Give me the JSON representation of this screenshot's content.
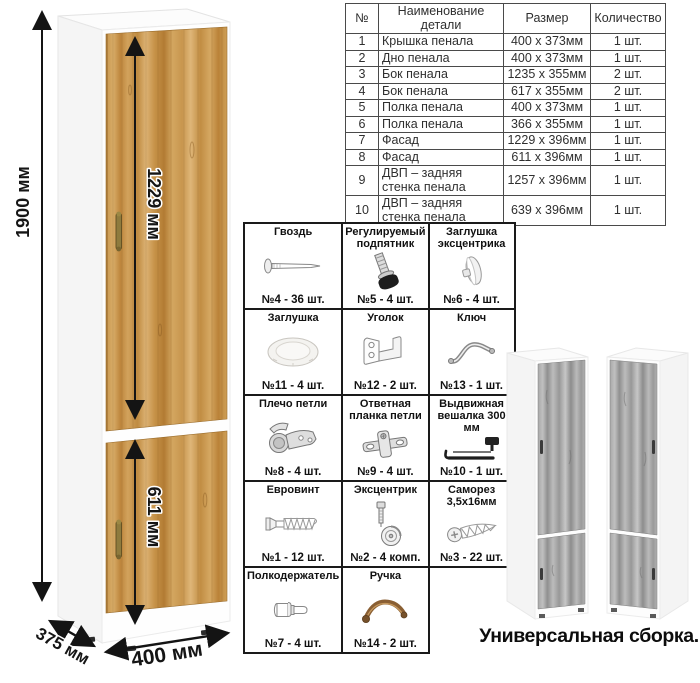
{
  "diagram": {
    "dims": {
      "height_label": "1900 мм",
      "upper_door_label": "1229 мм",
      "lower_door_label": "611 мм",
      "depth_label": "375 мм",
      "width_label": "400 мм"
    },
    "colors": {
      "wood": "#c6954e",
      "wood_dark": "#a97a38",
      "gray_wood": "#a9a9a9",
      "handle_bronze": "#8e7b3e",
      "line": "#151515",
      "table_border": "#4a4a4a"
    }
  },
  "parts_table": {
    "headers": [
      "№",
      "Наименование детали",
      "Размер",
      "Количество"
    ],
    "rows": [
      {
        "num": "1",
        "name": "Крышка пенала",
        "size": "400 х 373мм",
        "qty": "1 шт."
      },
      {
        "num": "2",
        "name": "Дно пенала",
        "size": "400 х 373мм",
        "qty": "1 шт."
      },
      {
        "num": "3",
        "name": "Бок пенала",
        "size": "1235 х 355мм",
        "qty": "2 шт."
      },
      {
        "num": "4",
        "name": "Бок пенала",
        "size": "617 х 355мм",
        "qty": "2 шт."
      },
      {
        "num": "5",
        "name": "Полка пенала",
        "size": "400 х 373мм",
        "qty": "1 шт."
      },
      {
        "num": "6",
        "name": "Полка пенала",
        "size": "366 х 355мм",
        "qty": "1 шт."
      },
      {
        "num": "7",
        "name": "Фасад",
        "size": "1229 х 396мм",
        "qty": "1 шт."
      },
      {
        "num": "8",
        "name": "Фасад",
        "size": "611 х 396мм",
        "qty": "1 шт."
      },
      {
        "num": "9",
        "name": "ДВП – задняя стенка пенала",
        "size": "1257 х 396мм",
        "qty": "1 шт."
      },
      {
        "num": "10",
        "name": "ДВП – задняя стенка пенала",
        "size": "639 х 396мм",
        "qty": "1 шт."
      }
    ]
  },
  "hardware": {
    "items": [
      {
        "title": "Гвоздь",
        "icon": "nail-icon",
        "count": "№4 - 36 шт."
      },
      {
        "title": "Регулируемый подпятник",
        "icon": "adjustable-foot-icon",
        "count": "№5 - 4 шт."
      },
      {
        "title": "Заглушка эксцентрика",
        "icon": "cam-cover-icon",
        "count": "№6 - 4 шт."
      },
      {
        "title": "Заглушка",
        "icon": "plug-icon",
        "count": "№11 - 4 шт."
      },
      {
        "title": "Уголок",
        "icon": "corner-bracket-icon",
        "count": "№12 - 2 шт."
      },
      {
        "title": "Ключ",
        "icon": "key-icon",
        "count": "№13 - 1 шт."
      },
      {
        "title": "Плечо петли",
        "icon": "hinge-arm-icon",
        "count": "№8 - 4 шт."
      },
      {
        "title": "Ответная планка петли",
        "icon": "hinge-plate-icon",
        "count": "№9 - 4 шт."
      },
      {
        "title": "Выдвижная вешалка 300 мм",
        "icon": "pullout-hanger-icon",
        "count": "№10 - 1 шт."
      },
      {
        "title": "Евровинт",
        "icon": "euroscrew-icon",
        "count": "№1 - 12 шт."
      },
      {
        "title": "Эксцентрик",
        "icon": "cam-lock-icon",
        "count": "№2 - 4 комп."
      },
      {
        "title": "Саморез 3,5х16мм",
        "icon": "self-tapping-screw-icon",
        "count": "№3 - 22 шт."
      },
      {
        "title": "Полкодержатель",
        "icon": "shelf-pin-icon",
        "count": "№7 - 4 шт."
      },
      {
        "title": "Ручка",
        "icon": "handle-icon",
        "count": "№14 - 2 шт."
      }
    ]
  },
  "footer": {
    "caption": "Универсальная сборка."
  }
}
